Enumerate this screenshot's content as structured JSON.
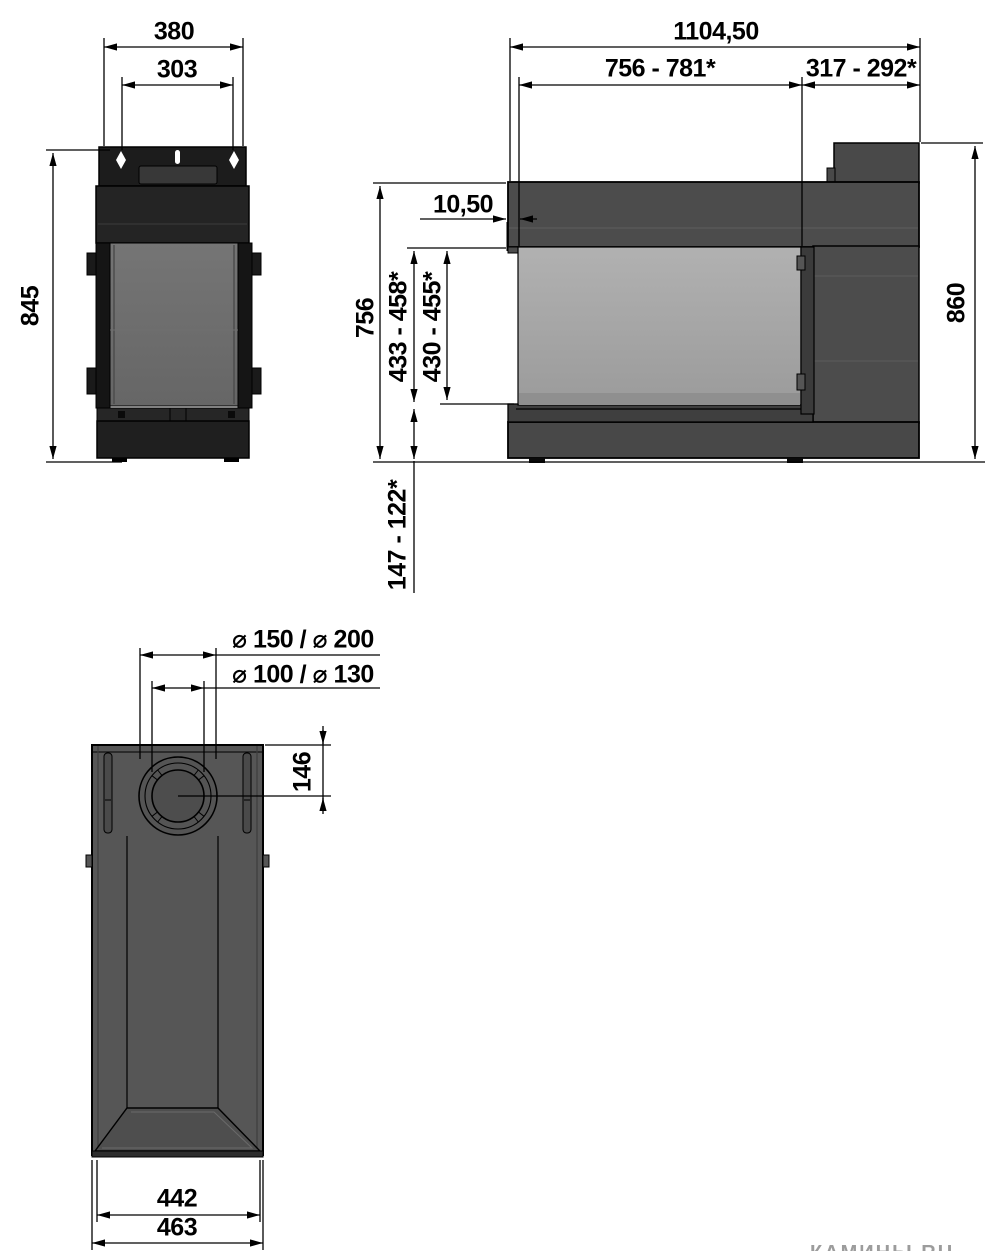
{
  "drawing_type": "fireplace installation dimension drawing",
  "watermark": "КАМИНЫ.RU",
  "colors": {
    "line": "#000000",
    "body_dark_grey": "#4c4c4c",
    "body_near_black": "#1f1f1f",
    "glass_front": "#a6a6a6",
    "glass_side": "#6f6f6f",
    "top_view_grey": "#565656"
  },
  "views": {
    "side_view": {
      "title": "side elevation",
      "dims": {
        "outer_width": "380",
        "hole_spacing": "303",
        "height": "845"
      }
    },
    "front_view": {
      "title": "front elevation",
      "dims": {
        "overall_width": "1104,50",
        "glass_section_width": "756 - 781*",
        "side_section_width": "317 - 292*",
        "frame_offset": "10,50",
        "front_height": "756",
        "opening_height_a": "433 - 458*",
        "opening_height_b": "430 - 455*",
        "overall_height": "860",
        "plinth_height": "147 - 122*"
      }
    },
    "top_view": {
      "title": "top view",
      "dims": {
        "flue_outer_diameters": "⌀ 150 / ⌀ 200",
        "flue_inner_diameters": "⌀ 100 / ⌀ 130",
        "flue_center_offset": "146",
        "glass_front_width": "442",
        "overall_depth_width": "463"
      }
    }
  }
}
